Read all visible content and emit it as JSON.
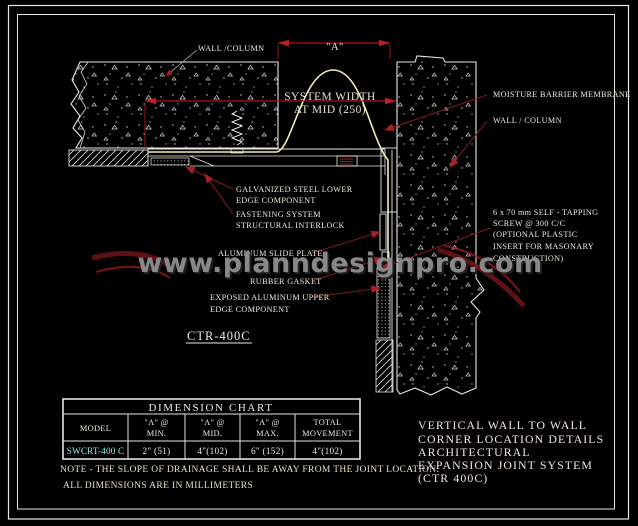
{
  "colors": {
    "background": "#000000",
    "line_white": "#e8e8e2",
    "dimension_red": "#a6161f",
    "leader_red": "#7e1919",
    "membrane_yellow": "#f2edb2",
    "model_cyan": "#86efe9",
    "watermark_gray": "#8f8f8f",
    "note_beige": "#eae1c4"
  },
  "watermark": {
    "text": "www.planndesignpro.com"
  },
  "labels": {
    "wall_column_top": "WALL /COLUMN",
    "dim_a": "\"A\"",
    "system_width_line1": "SYSTEM WIDTH",
    "system_width_line2": "AT MID (250)",
    "moisture_membrane": "MOISTURE BARRIER MEMBRANE",
    "wall_column_right": "WALL / COLUMN",
    "screw_lines": [
      "6 x 70 mm SELF - TAPPING",
      "SCREW @ 300 C/C",
      "(OPTIONAL PLASTIC",
      "INSERT FOR MASONARY",
      "CONSTRUCTION)"
    ],
    "galvanized_line1": "GALVANIZED STEEL LOWER",
    "galvanized_line2": "EDGE COMPONENT",
    "fastening_line1": "FASTENING SYSTEM",
    "fastening_line2": "STRUCTURAL INTERLOCK",
    "slide_plate": "ALUMINUM SLIDE PLATE",
    "rubber_gasket": "RUBBER GASKET",
    "exposed_line1": "EXPOSED ALUMINUM UPPER",
    "exposed_line2": "EDGE COMPONENT",
    "detail_name": "CTR-400C"
  },
  "table": {
    "title": "DIMENSION CHART",
    "col_model": "MODEL",
    "col_a": "\"A\" @",
    "col_min": "MIN.",
    "col_mid": "MID.",
    "col_max": "MAX.",
    "col_total1": "TOTAL",
    "col_total2": "MOVEMENT",
    "row": {
      "model": "SWCRT-400 C",
      "a_min": "2\" (51)",
      "a_mid": "4\"(102)",
      "a_max": "6\" (152)",
      "total": "4\"(102)"
    }
  },
  "notes": {
    "note1": "NOTE - THE SLOPE OF DRAINAGE SHALL BE AWAY FROM THE JOINT LOCATION.",
    "note2": "ALL DIMENSIONS ARE IN MILLIMETERS"
  },
  "title_block": {
    "lines": [
      "VERTICAL WALL TO WALL",
      "CORNER LOCATION DETAILS",
      "ARCHITECTURAL",
      "EXPANSION JOINT SYSTEM",
      "(CTR 400C)"
    ]
  }
}
